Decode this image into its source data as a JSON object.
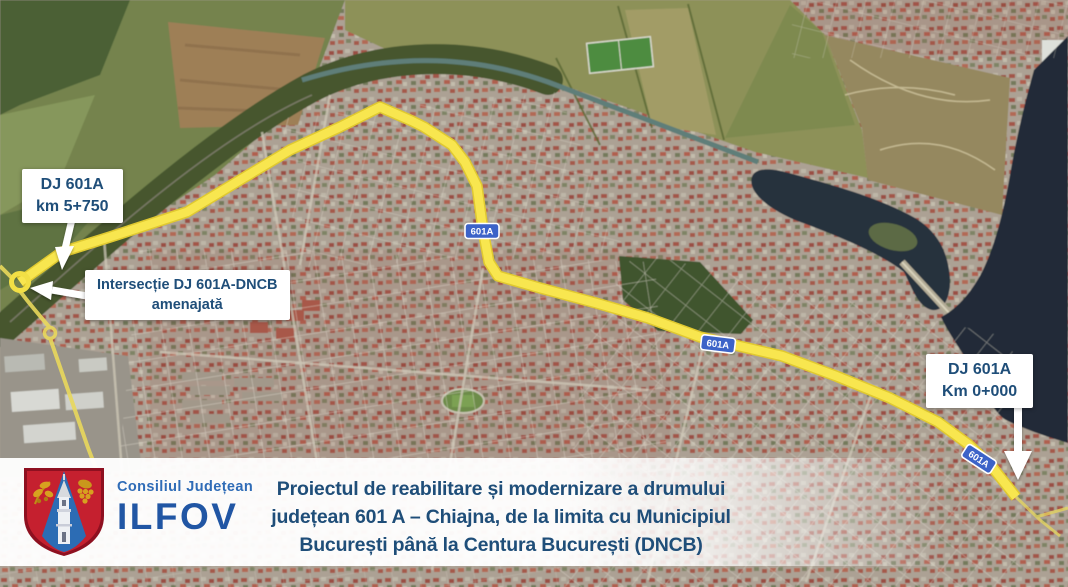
{
  "map": {
    "road_badge": "601A",
    "labels": {
      "start": {
        "line1": "DJ 601A",
        "line2": "km 5+750"
      },
      "intersection": {
        "line1": "Intersecție DJ 601A-DNCB",
        "line2": "amenajată"
      },
      "end": {
        "line1": "DJ 601A",
        "line2": "Km 0+000"
      }
    }
  },
  "footer": {
    "council": {
      "line1": "Consiliul Județean",
      "line2": "ILFOV"
    },
    "title": {
      "line1": "Proiectul de reabilitare și modernizare a drumului",
      "line2": "județean 601 A – Chiajna, de la limita cu Municipiul",
      "line3": "București până la Centura București (DNCB)"
    }
  },
  "colors": {
    "route_yellow": "#f8e64f",
    "badge_blue": "#3c63c8",
    "label_text_blue": "#1f4e79",
    "logo_blue": "#2156a4",
    "lake_dark": "#222b37"
  }
}
